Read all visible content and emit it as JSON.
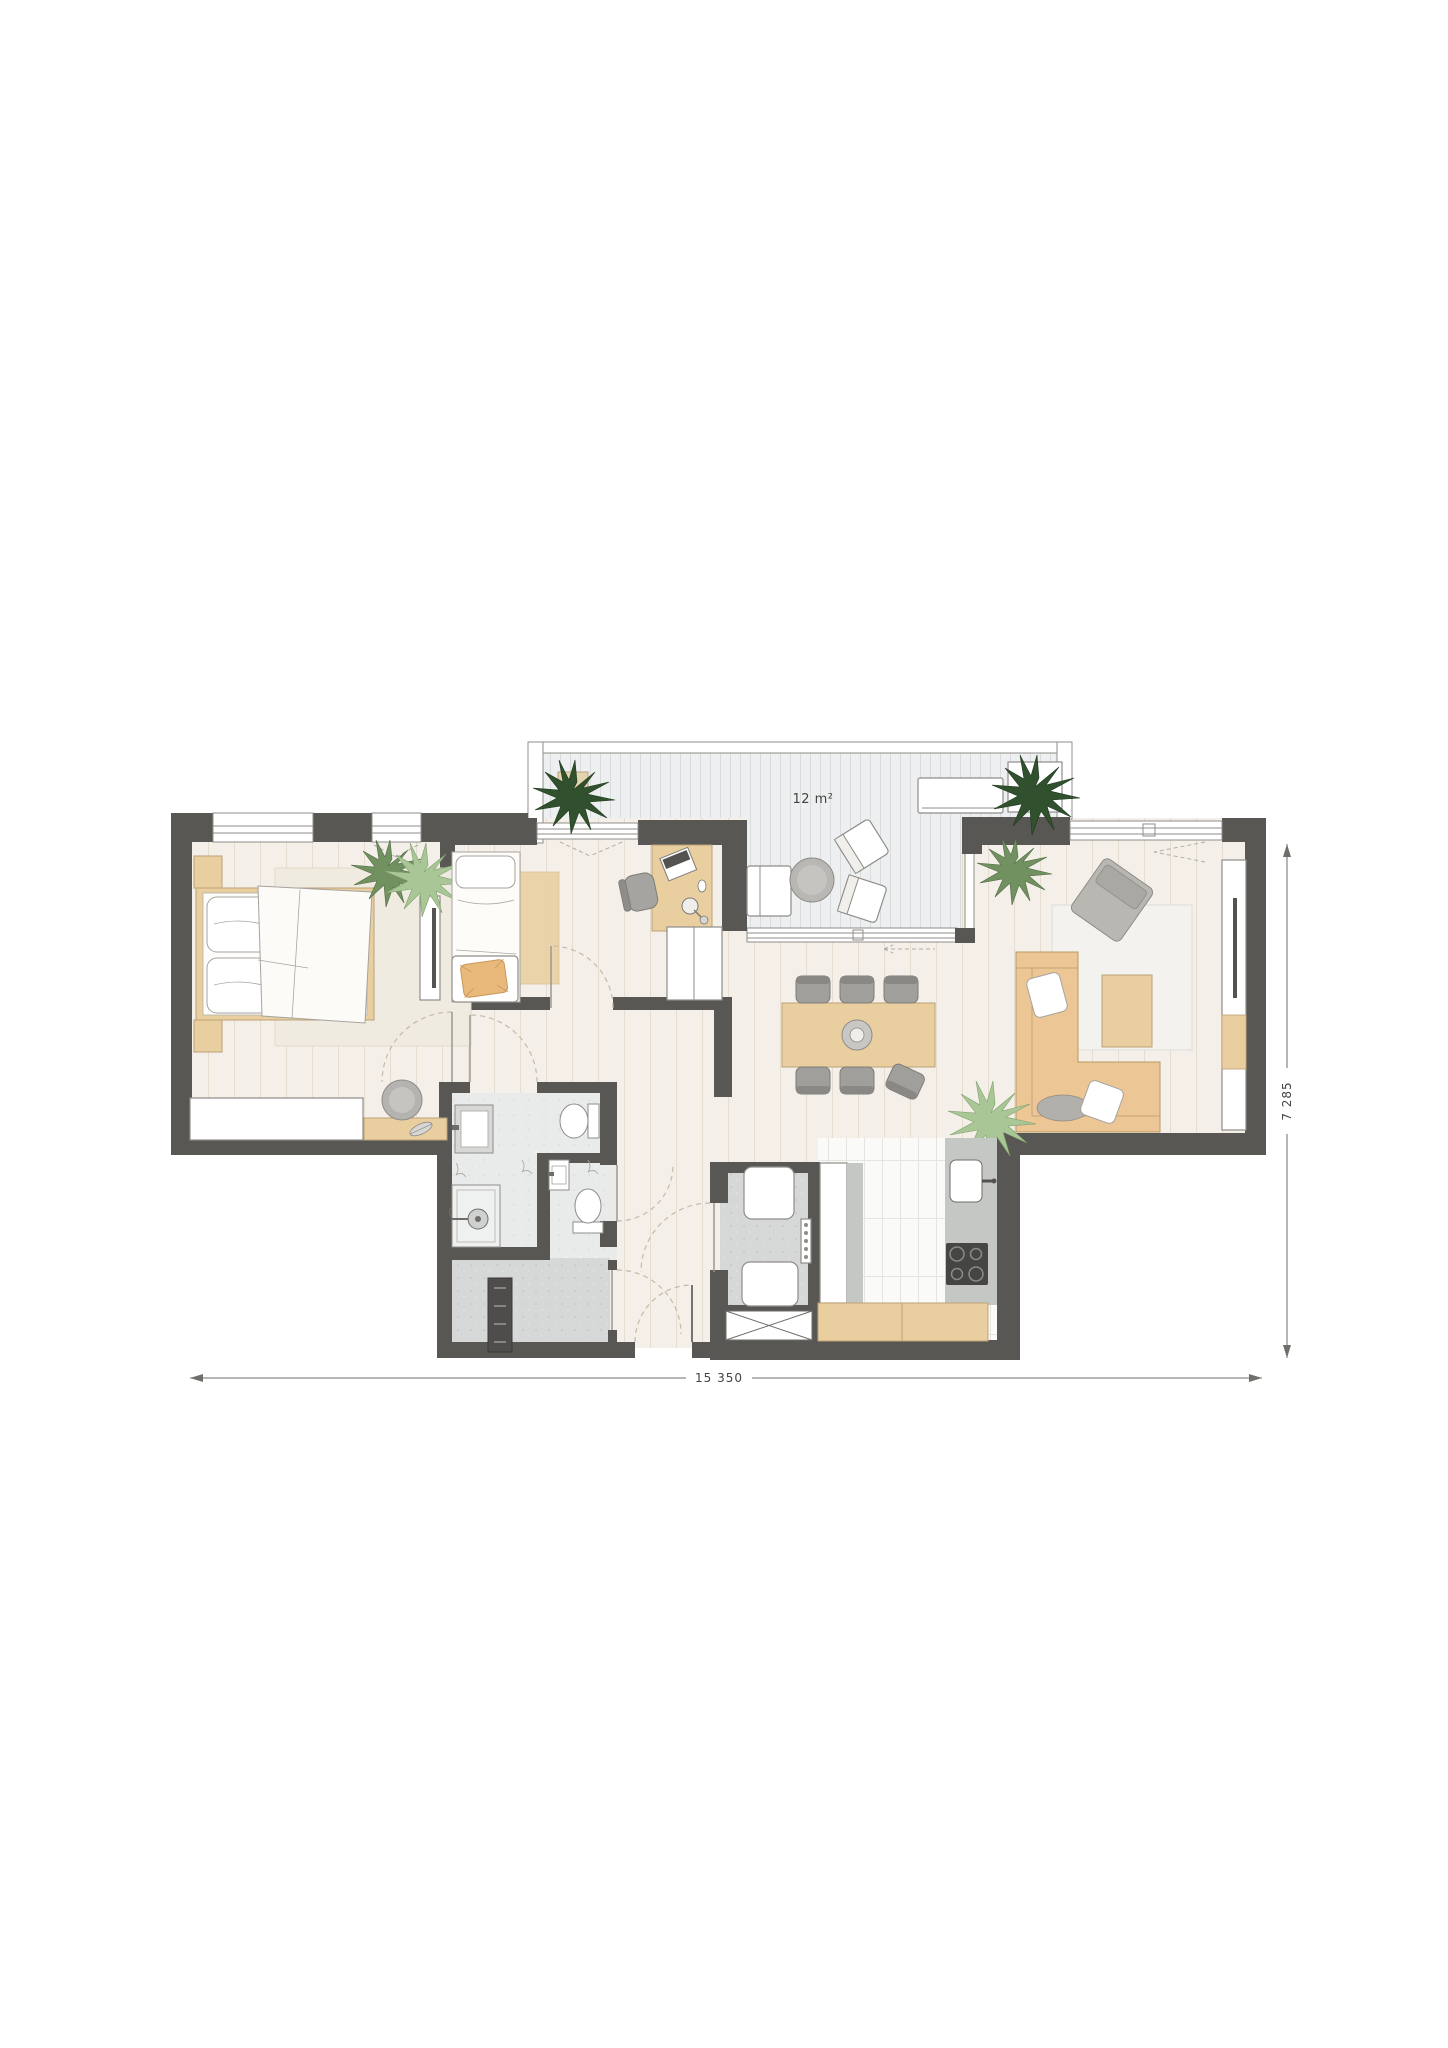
{
  "plan": {
    "balcony_area_label": "12 m²",
    "dimensions": {
      "width_label": "15 350",
      "height_label": "7 285"
    }
  },
  "colors": {
    "wall": "#585753",
    "floor_interior": "#f4efe8",
    "floor_plank_line": "#e5ddd0",
    "floor_balcony": "#edeff0",
    "balcony_plank_line": "#d8dcdc",
    "floor_bathroom": "#e9ebeb",
    "floor_utility": "#d6d8d8",
    "floor_kitchen_tile": "#fafaf8",
    "furniture_tan": "#e9cf9f",
    "furniture_tan_dark": "#e2b97f",
    "counter_gray": "#c5c7c5",
    "stove_dark": "#454543",
    "plant_dark": "#31502e",
    "plant_medium": "#729161",
    "plant_light": "#a9c697",
    "gray_furniture": "#b2b0ab",
    "chair_gray": "#a19f9b",
    "outline": "#8f8d88",
    "dimension_line": "#6f6e6a",
    "text": "#45443f"
  }
}
